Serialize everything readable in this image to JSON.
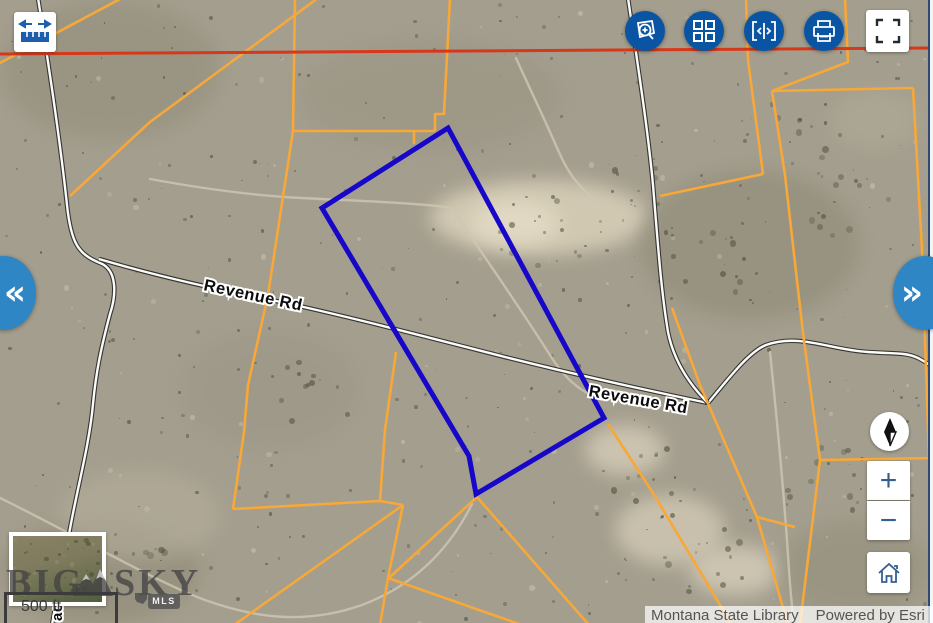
{
  "toolbar": {
    "accent_color": "#0a55a3",
    "buttons": [
      {
        "id": "zoom-to-area",
        "icon": "magnifier-area-icon"
      },
      {
        "id": "basemap-gallery",
        "icon": "grid-icon"
      },
      {
        "id": "swipe",
        "icon": "swipe-brackets-icon"
      },
      {
        "id": "print",
        "icon": "printer-icon"
      },
      {
        "id": "fullscreen",
        "icon": "expand-icon"
      }
    ]
  },
  "measure_tool": {
    "icon": "measure-arrows-ruler-icon"
  },
  "side_tabs": {
    "collapse_left": "«",
    "expand_right": "»",
    "color": "#2e86c4"
  },
  "nav": {
    "zoom_in": "+",
    "zoom_out": "−",
    "home_icon": "home-icon",
    "compass_icon": "north-arrow-icon"
  },
  "map": {
    "road_labels": {
      "revenue_rd_1": "Revenue Rd",
      "revenue_rd_2": "Revenue Rd",
      "vertical_partial": "ack"
    },
    "scale_bar": "500 ft",
    "attribution": {
      "source": "Montana State Library",
      "powered": "Powered by Esri"
    },
    "watermark": {
      "word1": "BIG",
      "word2": "SKY",
      "badge": "MLS"
    },
    "colors": {
      "parcel_line": "#f7a838",
      "subject_parcel": "#1607c9",
      "section_line": "#d8381a",
      "terrain_base": "#a49e8e"
    }
  }
}
